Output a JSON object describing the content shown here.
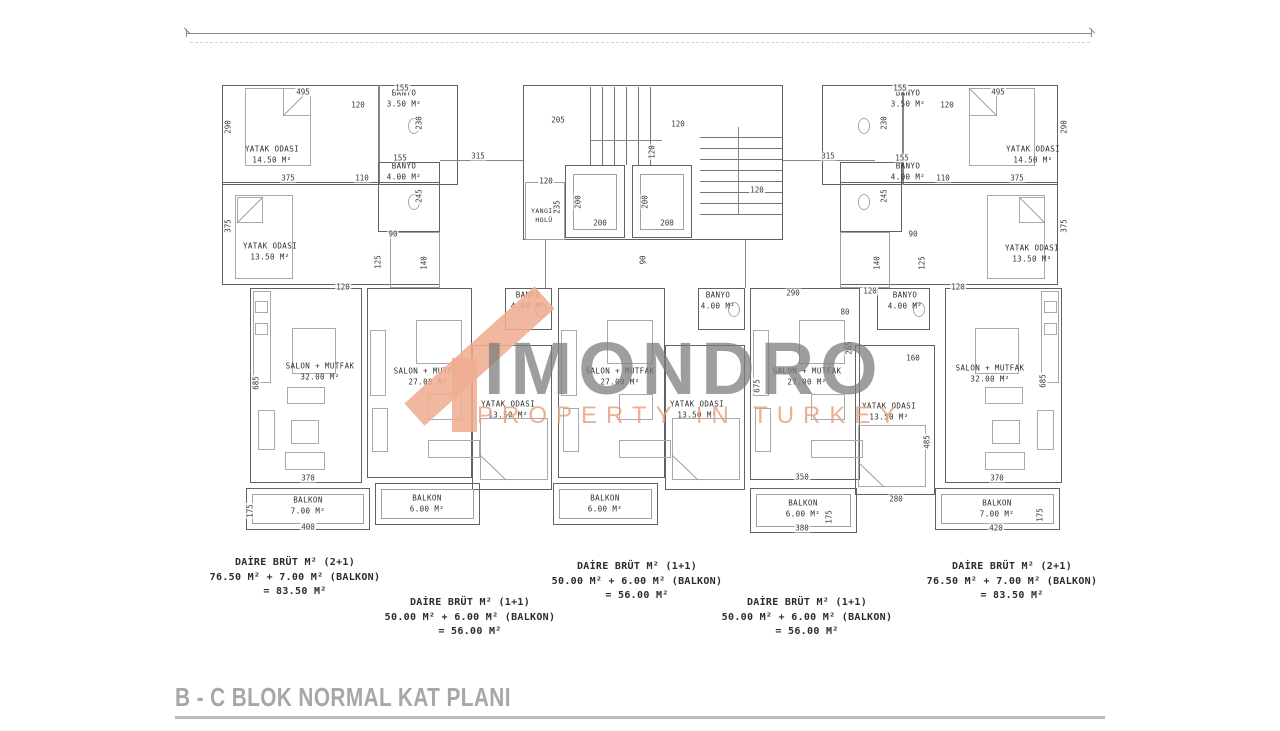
{
  "title": "B - C BLOK NORMAL KAT PLANI",
  "watermark": {
    "brand": "IMONDRO",
    "tagline": "PROPERTY IN TURKEY"
  },
  "rooms": {
    "tl_bedroom1": {
      "name": "YATAK ODASI",
      "area": "14.50 M²"
    },
    "tl_banyo1": {
      "name": "BANYO",
      "area": "3.50 M²"
    },
    "tl_bedroom2": {
      "name": "YATAK ODASI",
      "area": "13.50 M²"
    },
    "tl_banyo2": {
      "name": "BANYO",
      "area": "4.00 M²"
    },
    "tr_bedroom1": {
      "name": "YATAK ODASI",
      "area": "14.50 M²"
    },
    "tr_banyo1": {
      "name": "BANYO",
      "area": "3.50 M²"
    },
    "tr_bedroom2": {
      "name": "YATAK ODASI",
      "area": "13.50 M²"
    },
    "tr_banyo2": {
      "name": "BANYO",
      "area": "4.00 M²"
    },
    "fire_lobby": {
      "name": "YANGIN",
      "area": "HOLÜ"
    },
    "apt1_salon": {
      "name": "SALON + MUTFAK",
      "area": "32.00 M²"
    },
    "apt2_salon": {
      "name": "SALON + MUTFAK",
      "area": "27.00 M²"
    },
    "apt2_banyo": {
      "name": "BANYO",
      "area": "4.00 M²"
    },
    "apt2_bedroom": {
      "name": "YATAK ODASI",
      "area": "13.50 M²"
    },
    "apt3_salon": {
      "name": "SALON + MUTFAK",
      "area": "27.00 M²"
    },
    "apt3_banyo": {
      "name": "BANYO",
      "area": "4.00 M²"
    },
    "apt3_bedroom": {
      "name": "YATAK ODASI",
      "area": "13.50 M²"
    },
    "apt4_salon": {
      "name": "SALON + MUTFAK",
      "area": "27.00 M²"
    },
    "apt4_banyo": {
      "name": "BANYO",
      "area": "4.00 M²"
    },
    "apt4_bedroom": {
      "name": "YATAK ODASI",
      "area": "13.50 M²"
    },
    "apt5_salon": {
      "name": "SALON + MUTFAK",
      "area": "32.00 M²"
    },
    "balkon1": {
      "name": "BALKON",
      "area": "7.00 M²"
    },
    "balkon2": {
      "name": "BALKON",
      "area": "6.00 M²"
    },
    "balkon3": {
      "name": "BALKON",
      "area": "6.00 M²"
    },
    "balkon4": {
      "name": "BALKON",
      "area": "6.00 M²"
    },
    "balkon5": {
      "name": "BALKON",
      "area": "7.00 M²"
    }
  },
  "dims": {
    "d495": "495",
    "d120": "120",
    "d155": "155",
    "d230": "230",
    "d290": "290",
    "d375": "375",
    "d110": "110",
    "d245": "245",
    "d90": "90",
    "d125": "125",
    "d140": "140",
    "d205": "205",
    "d315": "315",
    "d235": "235",
    "d200": "200",
    "d685": "685",
    "d370": "370",
    "d400": "400",
    "d175": "175",
    "d675": "675",
    "d350": "350",
    "d380": "380",
    "d280": "280",
    "d485": "485",
    "d420": "420",
    "d80": "80",
    "d265": "265",
    "d160": "160"
  },
  "summaries": [
    {
      "line1": "DAİRE BRÜT M² (2+1)",
      "line2": "76.50 M² + 7.00 M² (BALKON)",
      "line3": "= 83.50 M²"
    },
    {
      "line1": "DAİRE BRÜT M² (1+1)",
      "line2": "50.00 M² + 6.00 M² (BALKON)",
      "line3": "= 56.00 M²"
    },
    {
      "line1": "DAİRE BRÜT M² (1+1)",
      "line2": "50.00 M² + 6.00 M² (BALKON)",
      "line3": "= 56.00 M²"
    },
    {
      "line1": "DAİRE BRÜT M² (1+1)",
      "line2": "50.00 M² + 6.00 M² (BALKON)",
      "line3": "= 56.00 M²"
    },
    {
      "line1": "DAİRE BRÜT M² (2+1)",
      "line2": "76.50 M² + 7.00 M² (BALKON)",
      "line3": "= 83.50 M²"
    }
  ]
}
